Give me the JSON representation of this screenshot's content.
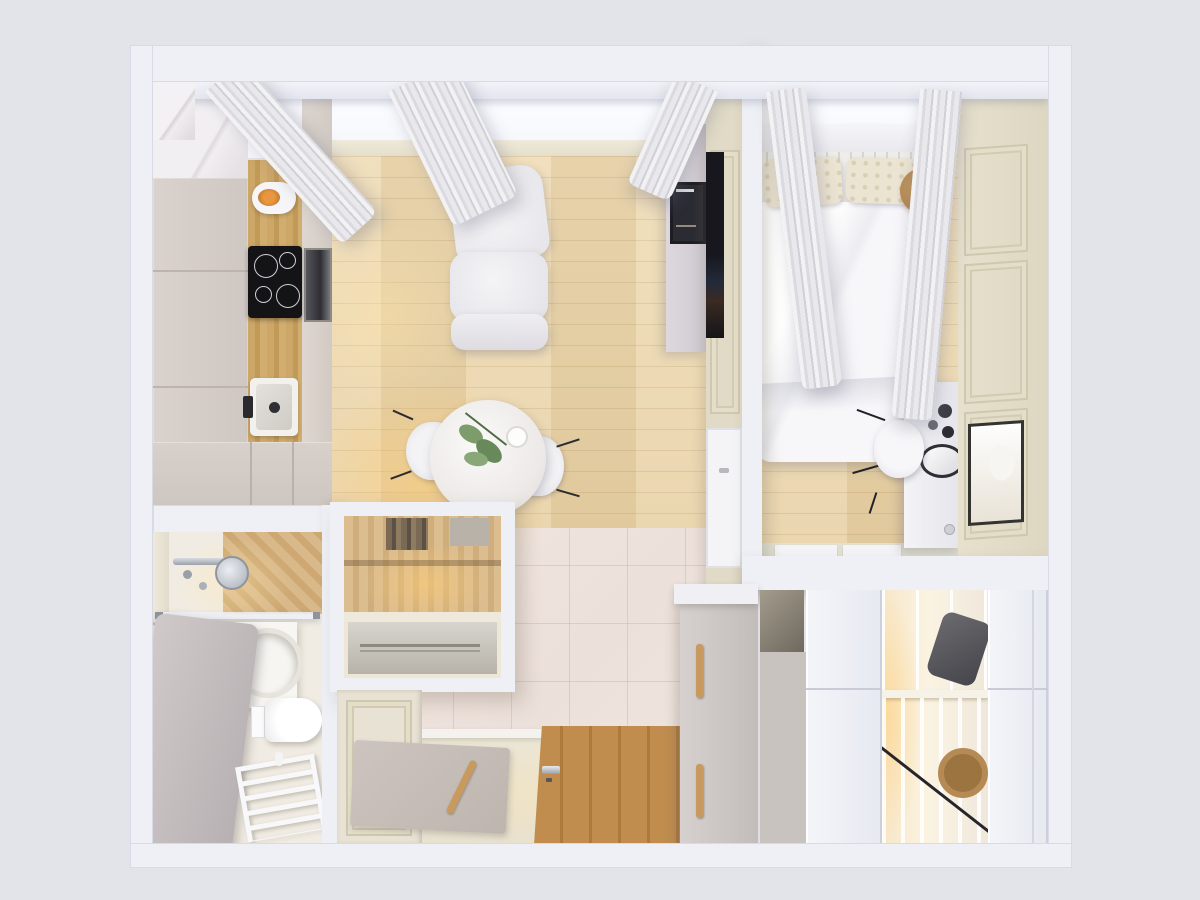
{
  "scene": {
    "kind": "photoreal 3d render, top-down floor plan of a one-bedroom apartment",
    "view": "bird's-eye / plan view",
    "palette": {
      "page_background": "#e3e3ea",
      "walls": "#eef0f6",
      "wood_floor": "#ecd8ae",
      "tile_floor": "#efe4de",
      "hall_floor": "#eae4d2",
      "kitchen_cabinets": "#d6cec9",
      "cream_panel_wall": "#e0dac6",
      "counter_wood": "#c89f63",
      "entry_door_wood": "#b9854d",
      "warm_light": "#ffd27e",
      "cooktop": "#141417"
    },
    "rooms": [
      {
        "name": "kitchen-living-room",
        "position": "top-left",
        "objects": [
          "tall kitchen cabinet column",
          "wood counter with kettle",
          "black 4-burner cooktop",
          "built-in oven",
          "square sink with black faucet",
          "white two-seat sofa",
          "round white dining table",
          "green plant centerpiece",
          "two white chairs",
          "tv sideboard",
          "wall tv",
          "framed poster",
          "window band with gray curtains",
          "wood plank floor",
          "warm floor lamp glow"
        ]
      },
      {
        "name": "bedroom",
        "position": "top-right",
        "objects": [
          "double bed with white duvet",
          "two patterned pillows",
          "slatted headboard with shelf",
          "round wooden side stool",
          "white desk with black accessories",
          "oval desk mirror",
          "white chair with black legs",
          "cream paneled wardrobe wall with moldings",
          "wall mirror",
          "curtains at window band",
          "wood plank floor"
        ]
      },
      {
        "name": "bathroom",
        "position": "bottom-left",
        "objects": [
          "chrome shower set",
          "wood shower tray",
          "glass screen",
          "white vanity with two round basins",
          "round leaning mirror",
          "gray bathtub partition",
          "wall-hung toilet",
          "flush plate",
          "white towel ladder radiator",
          "light tile floor"
        ]
      },
      {
        "name": "hallway",
        "position": "bottom-center",
        "objects": [
          "built-in storage nook with lit wood shelf and books",
          "metal bench surface",
          "cream paneled door",
          "pink tile floor",
          "gray doormat",
          "wood entry door with steel handle",
          "gray shoe cabinet with wood pull handles"
        ]
      },
      {
        "name": "walk-in-closet",
        "position": "bottom-right",
        "objects": [
          "white wardrobe doors left",
          "warm-lit open shelving",
          "folded dark clothes",
          "diagonal clothes rail",
          "round wicker basket",
          "white wardrobe doors right"
        ]
      }
    ]
  }
}
